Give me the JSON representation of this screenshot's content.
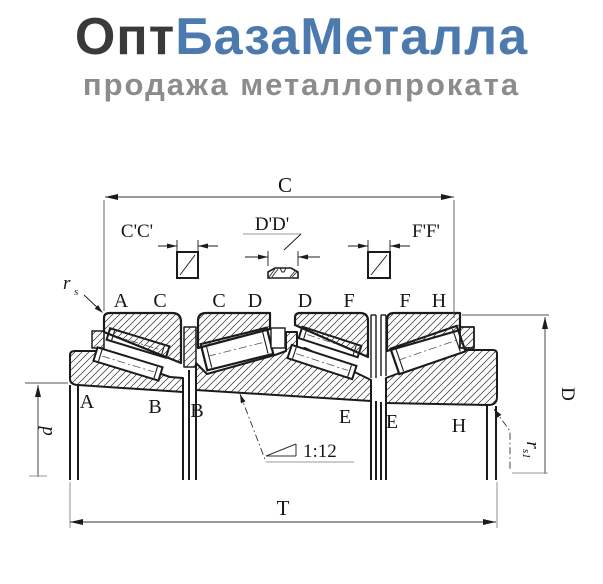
{
  "logo": {
    "title_dark": "Опт",
    "title_blue": "БазаМеталла",
    "subtitle": "продажа металлопроката",
    "dark_color": "#3a3a3c",
    "blue_color": "#4d7aae",
    "subtitle_color": "#8c8c8c"
  },
  "drawing": {
    "stroke_color": "#1b1b1b",
    "dims": {
      "c": "C",
      "t": "T",
      "d_outer": "D",
      "d_bore": "d",
      "taper": "1:12"
    },
    "sections": {
      "cc": "C'C'",
      "dd": "D'D'",
      "ff": "F'F'"
    },
    "radius_labels": {
      "rs_base": "r",
      "rs_sub": "s",
      "rs1_base": "r",
      "rs1_sub": "s1"
    },
    "top_letters": [
      "A",
      "C",
      "C",
      "D",
      "D",
      "F",
      "F",
      "H"
    ],
    "bottom_letters": [
      "A",
      "B",
      "B",
      "E",
      "E",
      "H"
    ]
  }
}
